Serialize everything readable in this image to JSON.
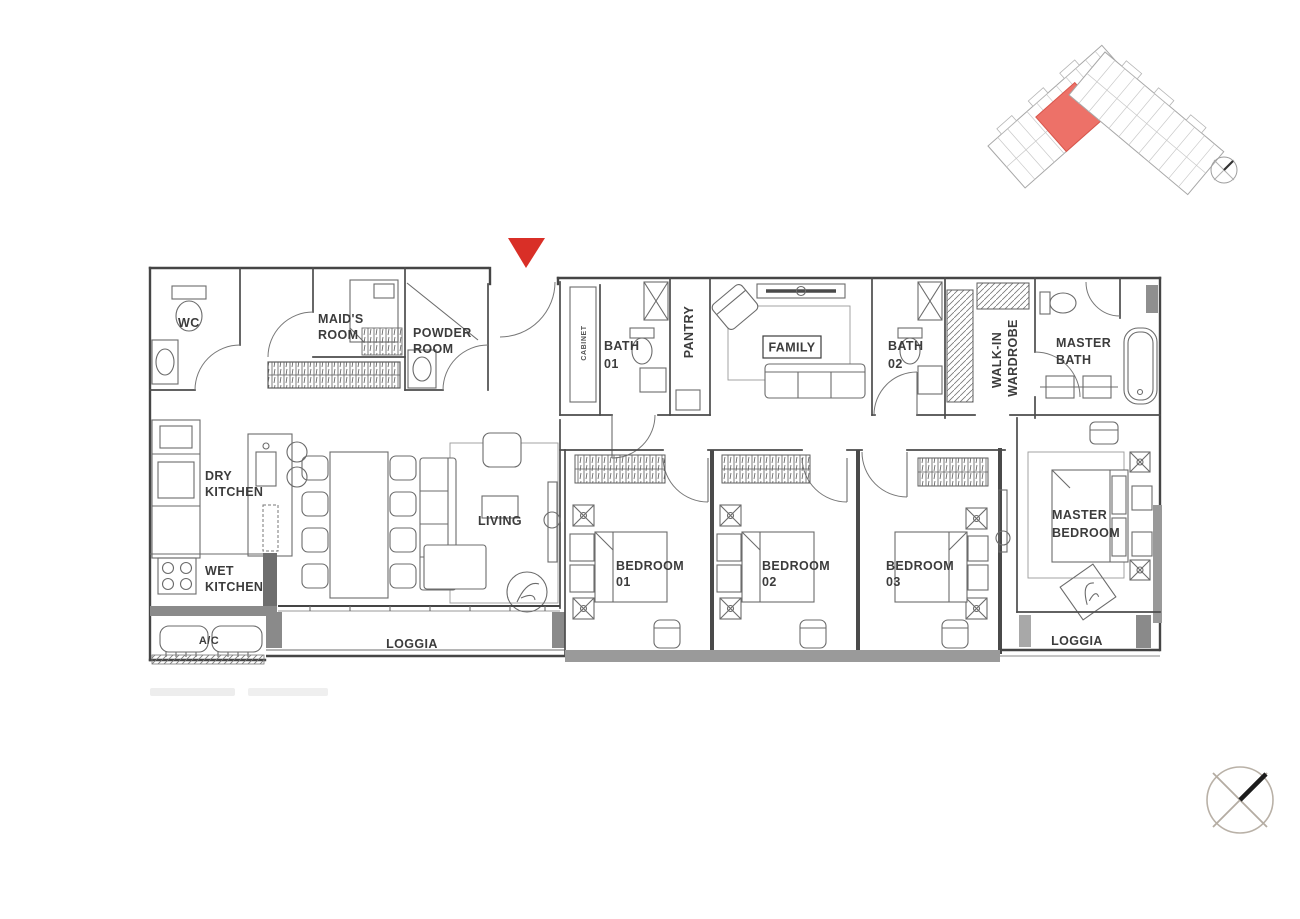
{
  "colors": {
    "background": "#ffffff",
    "wall_line": "#454545",
    "furniture_line": "#6b6b6b",
    "solid_band": "#8f8f8f",
    "entrance_marker_red": "#d92f27",
    "keyplan_unit_red": "#ed7168",
    "label_text": "#3c3c3c"
  },
  "floor_plan": {
    "rooms": {
      "wc": {
        "label": "WC"
      },
      "maids_room": {
        "lines": [
          "MAID'S",
          "ROOM"
        ]
      },
      "powder_room": {
        "lines": [
          "POWDER",
          "ROOM"
        ]
      },
      "cabinet": {
        "label": "CABINET"
      },
      "bath_01": {
        "lines": [
          "BATH",
          "01"
        ]
      },
      "pantry": {
        "label": "PANTRY"
      },
      "family": {
        "label": "FAMILY"
      },
      "bath_02": {
        "lines": [
          "BATH",
          "02"
        ]
      },
      "walk_in_wardrobe": {
        "lines": [
          "WALK-IN",
          "WARDROBE"
        ]
      },
      "master_bath": {
        "lines": [
          "MASTER",
          "BATH"
        ]
      },
      "dry_kitchen": {
        "lines": [
          "DRY",
          "KITCHEN"
        ]
      },
      "wet_kitchen": {
        "lines": [
          "WET",
          "KITCHEN"
        ]
      },
      "ac_ledge": {
        "label": "A/C"
      },
      "living": {
        "label": "LIVING"
      },
      "loggia_left": {
        "label": "LOGGIA"
      },
      "bedroom_01": {
        "lines": [
          "BEDROOM",
          "01"
        ]
      },
      "bedroom_02": {
        "lines": [
          "BEDROOM",
          "02"
        ]
      },
      "bedroom_03": {
        "lines": [
          "BEDROOM",
          "03"
        ]
      },
      "master_bedroom": {
        "lines": [
          "MASTER",
          "BEDROOM"
        ]
      },
      "loggia_right": {
        "label": "LOGGIA"
      }
    }
  }
}
